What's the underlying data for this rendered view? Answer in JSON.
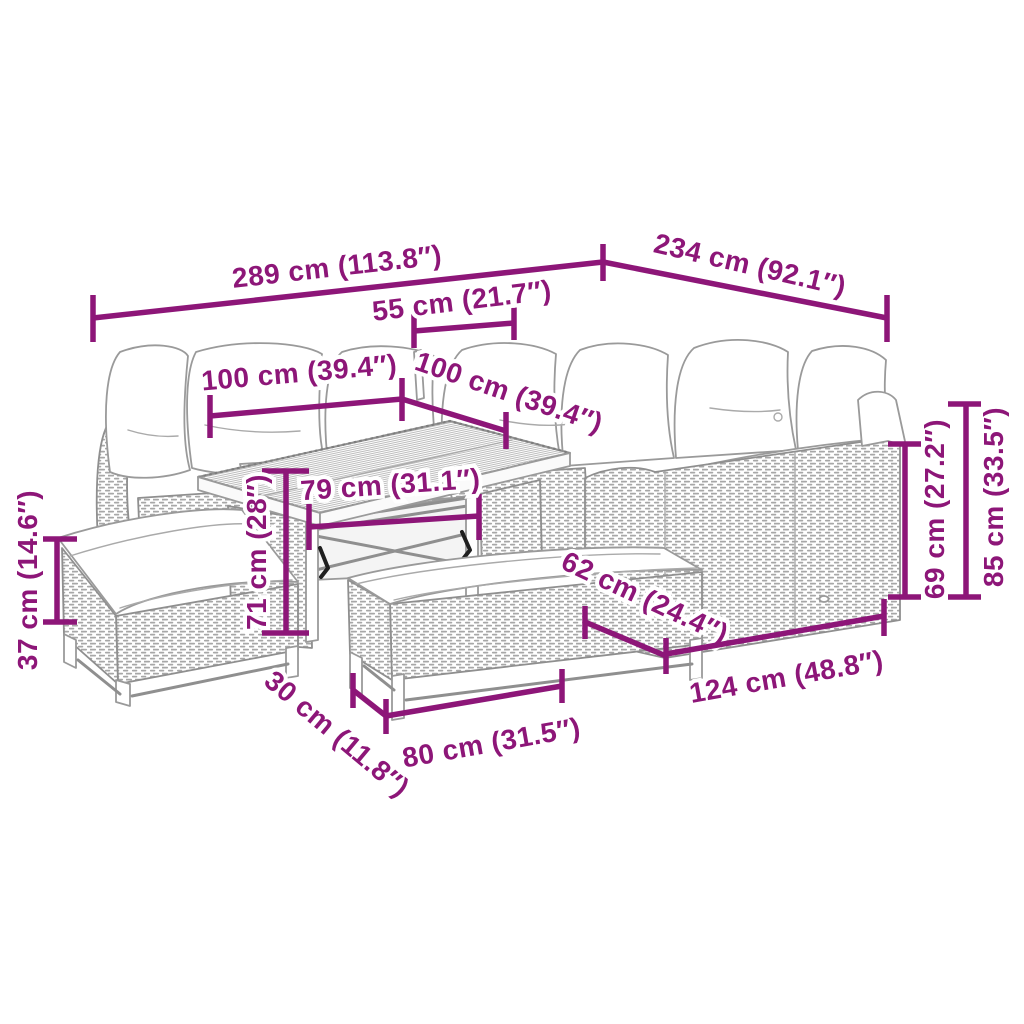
{
  "diagram": {
    "type": "product-dimension-diagram",
    "product": "Garden rattan lounge set with sofa, table and benches",
    "accent_color": "#8D1678",
    "background_color": "#FFFFFF",
    "unit_primary": "cm",
    "unit_secondary": "inches",
    "dimensions": [
      {
        "id": "overall-width",
        "label": "289 cm (113.8″)"
      },
      {
        "id": "overall-depth",
        "label": "234 cm (92.1″)"
      },
      {
        "id": "corner-seat-width",
        "label": "55 cm (21.7″)"
      },
      {
        "id": "left-sofa-width",
        "label": "100 cm (39.4″)"
      },
      {
        "id": "middle-sofa-width",
        "label": "100 cm (39.4″)"
      },
      {
        "id": "table-top-width",
        "label": "79 cm (31.1″)"
      },
      {
        "id": "table-height",
        "label": "71 cm (28″)"
      },
      {
        "id": "bench-height",
        "label": "37 cm (14.6″)"
      },
      {
        "id": "bench-depth",
        "label": "30 cm (11.8″)"
      },
      {
        "id": "bench-width",
        "label": "80 cm (31.5″)"
      },
      {
        "id": "sofa-depth",
        "label": "62 cm (24.4″)"
      },
      {
        "id": "right-sofa-width",
        "label": "124 cm (48.8″)"
      },
      {
        "id": "seat-back-height",
        "label": "69 cm (27.2″)"
      },
      {
        "id": "total-height",
        "label": "85 cm (33.5″)"
      }
    ]
  }
}
